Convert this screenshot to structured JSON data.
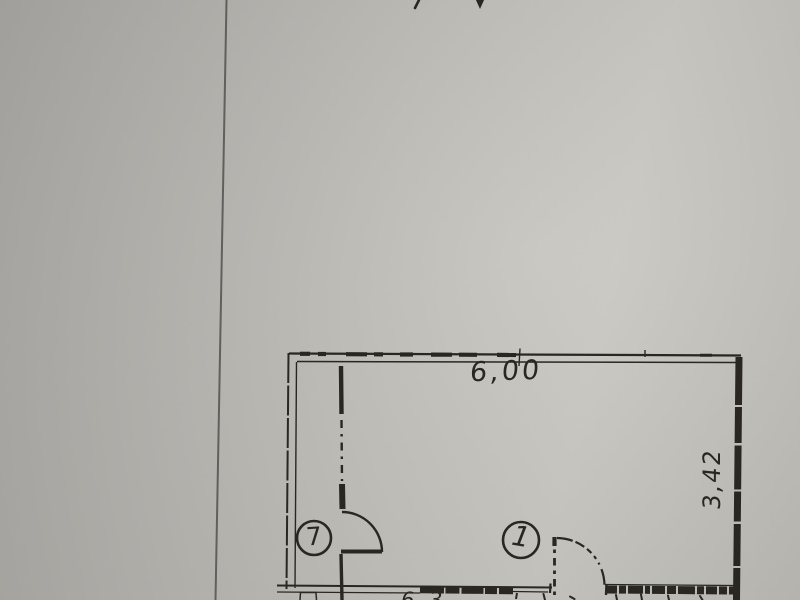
{
  "floor_plan": {
    "dimension_labels": {
      "top_width": "6,00",
      "right_height": "3,42",
      "bottom_partial": "6,3"
    },
    "room_labels": [
      {
        "number": "7"
      },
      {
        "number": "1"
      }
    ],
    "colors": {
      "paper": "#bdbbb5",
      "paper-dark": "#a7a5a1",
      "paper-light": "#c7c5bf",
      "ink": "#2a2722",
      "sheet-line": "#53514d"
    }
  }
}
